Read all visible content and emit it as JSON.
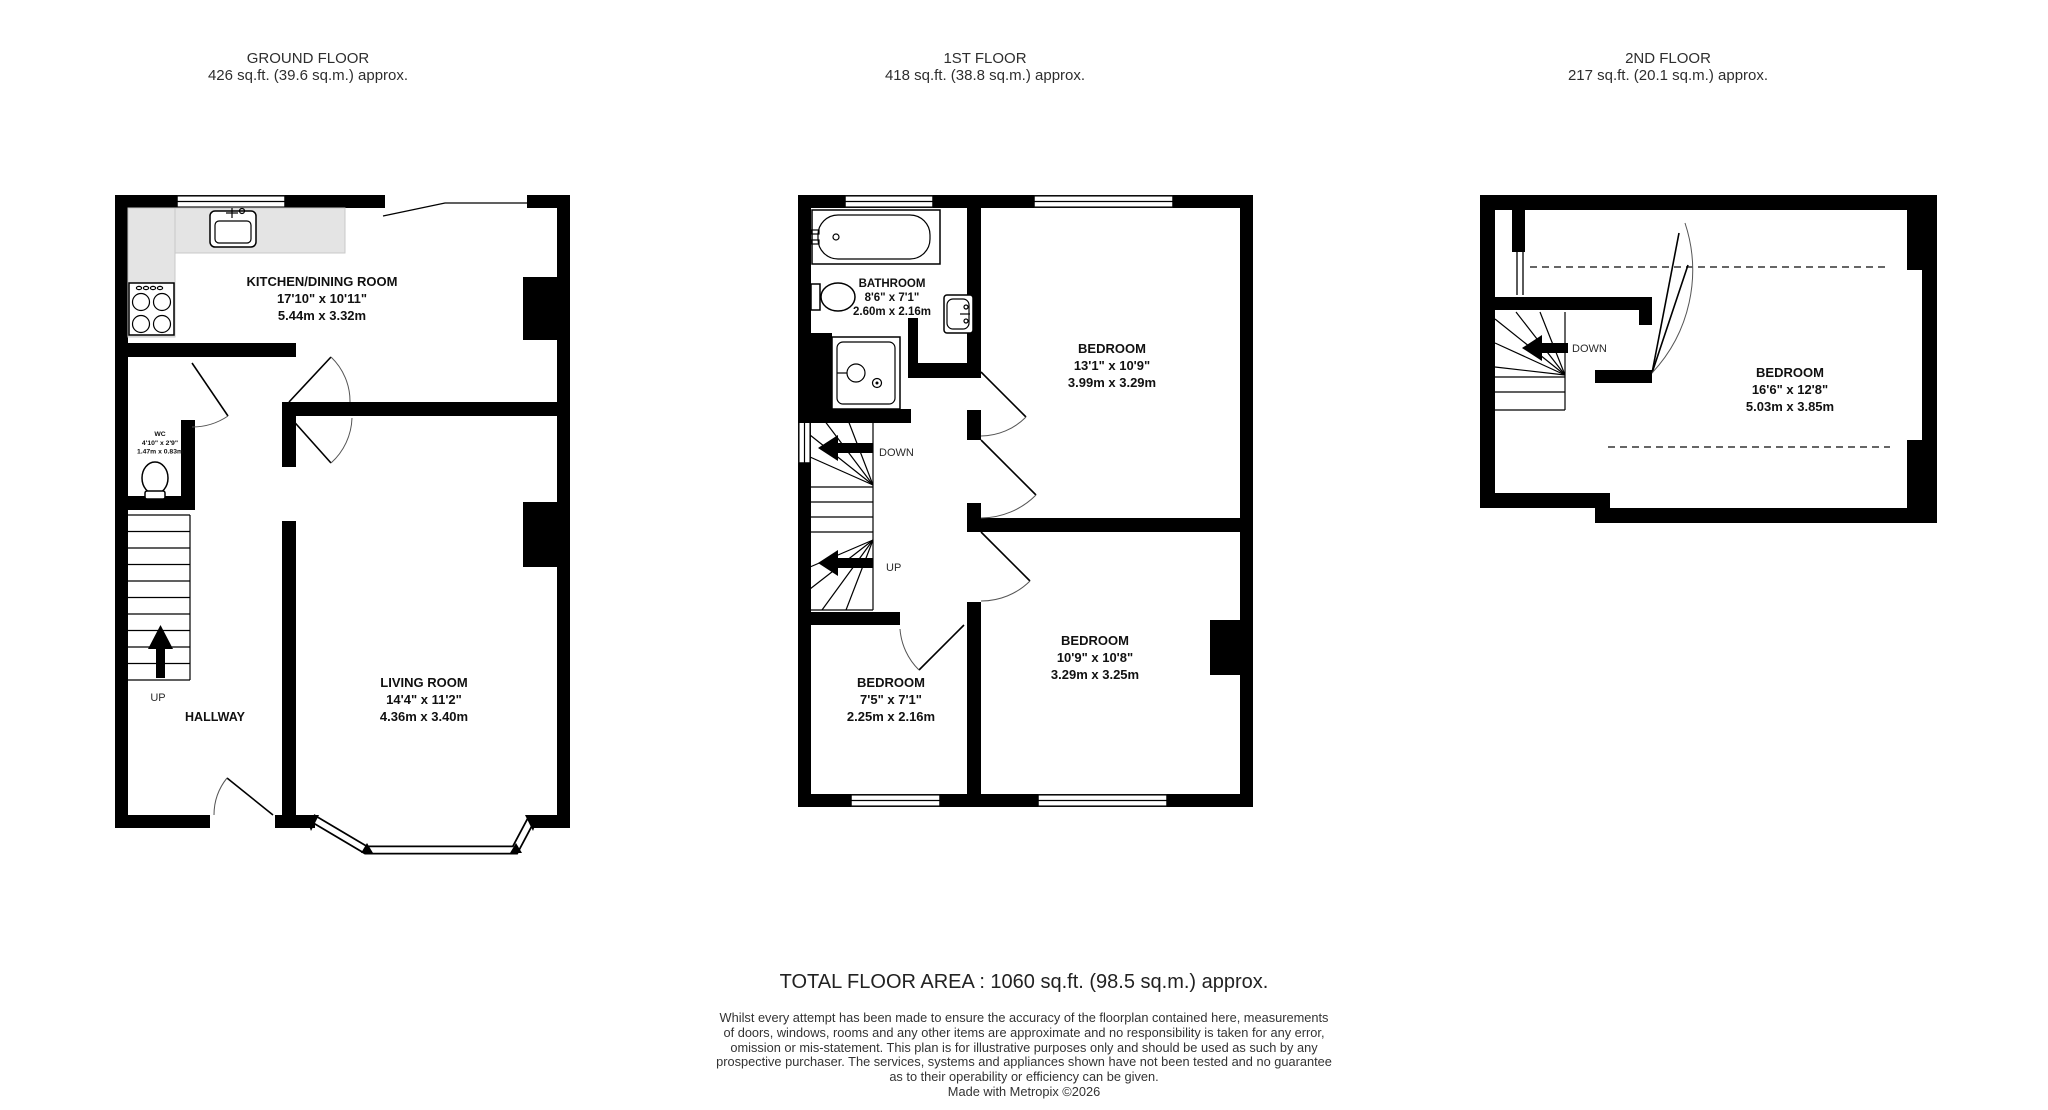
{
  "floors": [
    {
      "title": "GROUND FLOOR",
      "area": "426 sq.ft. (39.6 sq.m.) approx."
    },
    {
      "title": "1ST FLOOR",
      "area": "418 sq.ft. (38.8 sq.m.) approx."
    },
    {
      "title": "2ND FLOOR",
      "area": "217 sq.ft. (20.1 sq.m.) approx."
    }
  ],
  "rooms": {
    "kitchen": {
      "name": "KITCHEN/DINING ROOM",
      "imperial": "17'10\"  x 10'11\"",
      "metric": "5.44m  x 3.32m"
    },
    "wc": {
      "name": "WC",
      "imperial": "4'10\"  x 2'9\"",
      "metric": "1.47m  x 0.83m"
    },
    "living": {
      "name": "LIVING ROOM",
      "imperial": "14'4\"  x 11'2\"",
      "metric": "4.36m  x 3.40m"
    },
    "hallway": {
      "name": "HALLWAY"
    },
    "bathroom": {
      "name": "BATHROOM",
      "imperial": "8'6\"  x 7'1\"",
      "metric": "2.60m  x 2.16m"
    },
    "bedroom1": {
      "name": "BEDROOM",
      "imperial": "13'1\"  x 10'9\"",
      "metric": "3.99m  x 3.29m"
    },
    "bedroom2": {
      "name": "BEDROOM",
      "imperial": "10'9\"  x 10'8\"",
      "metric": "3.29m  x 3.25m"
    },
    "bedroom3": {
      "name": "BEDROOM",
      "imperial": "7'5\"  x 7'1\"",
      "metric": "2.25m  x 2.16m"
    },
    "bedroom4": {
      "name": "BEDROOM",
      "imperial": "16'6\"  x 12'8\"",
      "metric": "5.03m  x 3.85m"
    }
  },
  "stairs": {
    "up": "UP",
    "down": "DOWN"
  },
  "footer": {
    "total": "TOTAL FLOOR AREA : 1060 sq.ft. (98.5 sq.m.) approx.",
    "lines": [
      "Whilst every attempt has been made to ensure the accuracy of the floorplan contained here, measurements",
      "of doors, windows, rooms and any other items are approximate and no responsibility is taken for any error,",
      "omission or mis-statement. This plan is for illustrative purposes only and should be used as such by any",
      "prospective purchaser. The services, systems and appliances shown have not been tested and no guarantee",
      "as to their operability or efficiency can be given."
    ],
    "credit": "Made with Metropix ©2026"
  },
  "colors": {
    "wall": "#000000",
    "counter": "#e4e4e4",
    "text": "#111111"
  }
}
